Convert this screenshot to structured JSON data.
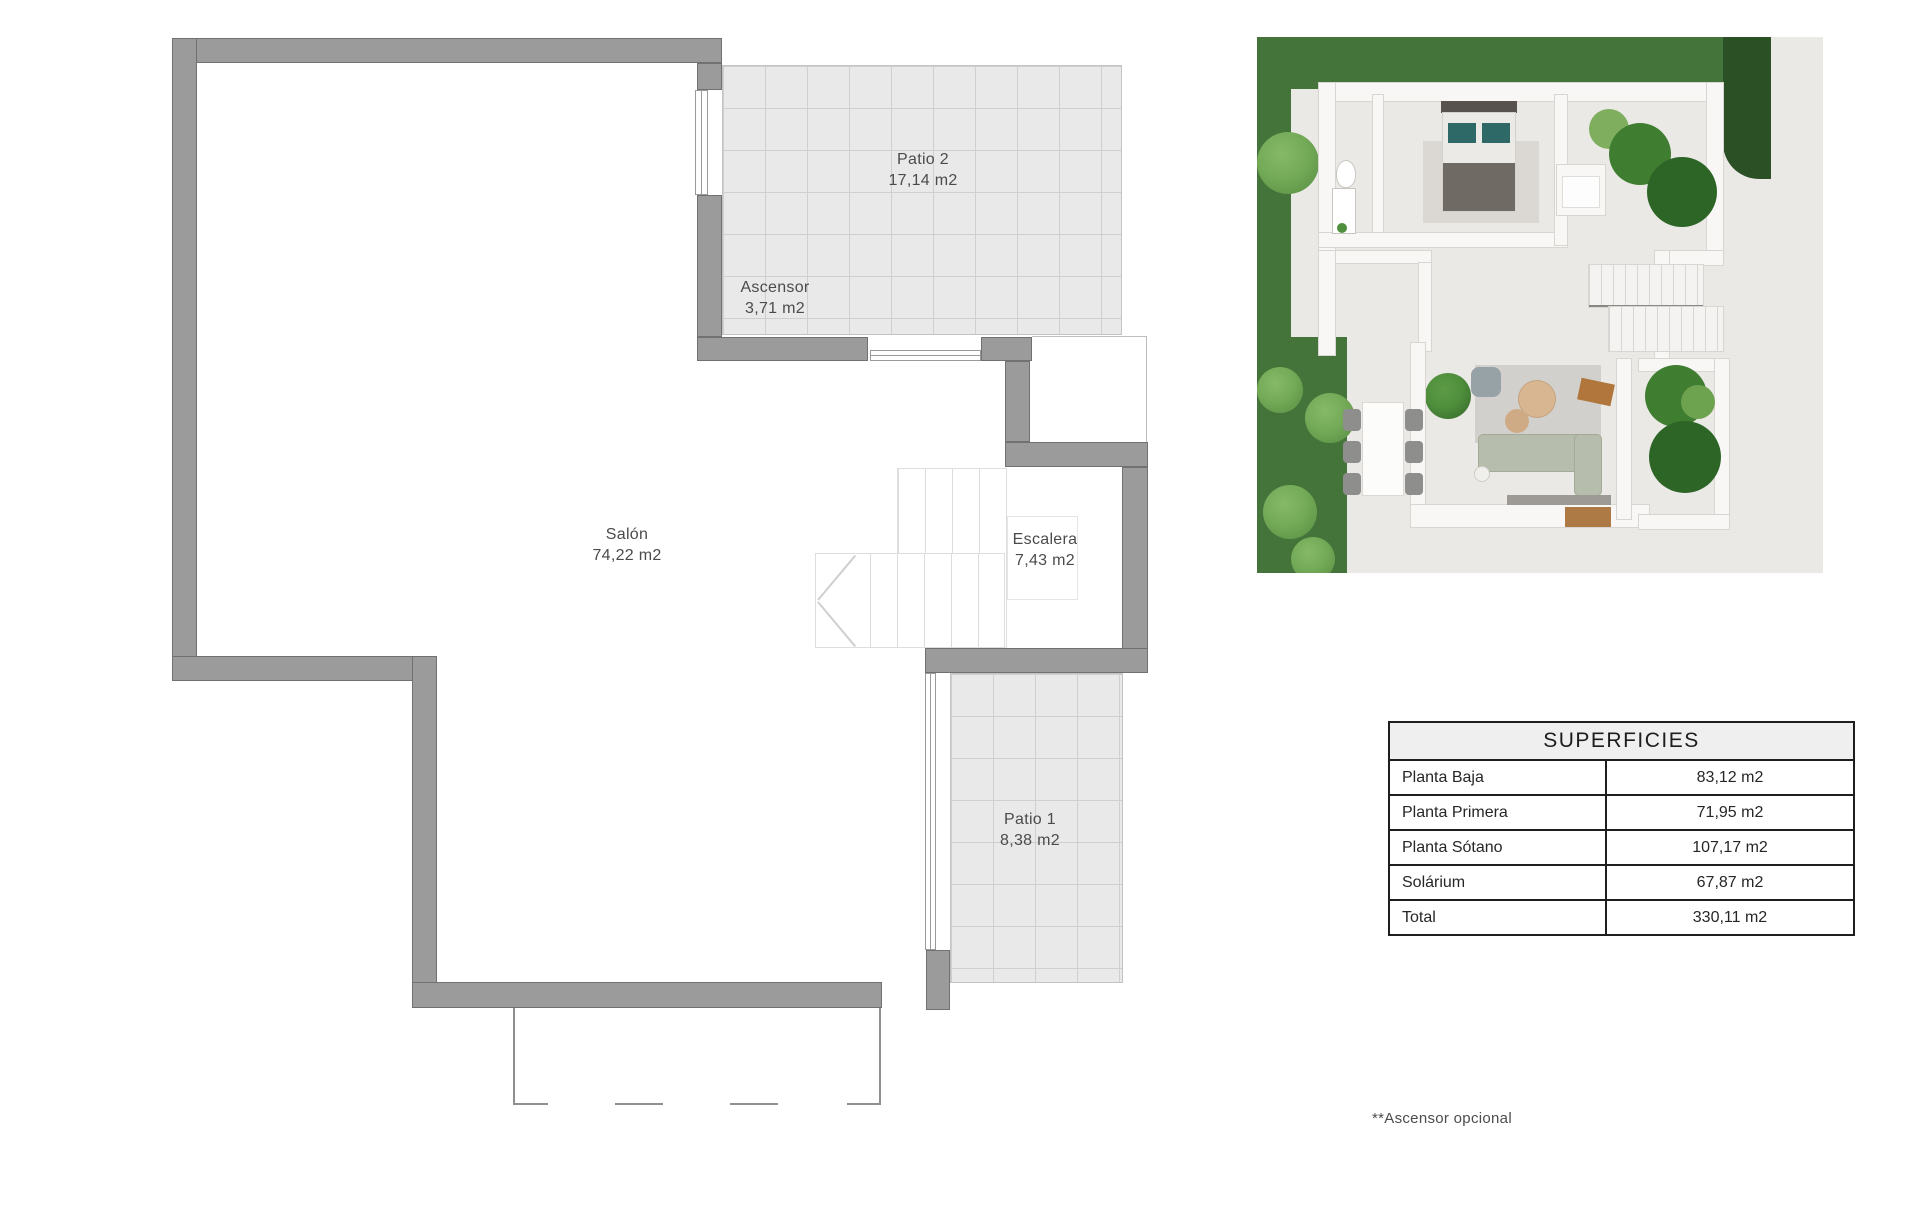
{
  "floorplan": {
    "rooms": [
      {
        "name": "Patio 2",
        "area": "17,14 m2"
      },
      {
        "name": "Ascensor",
        "area": "3,71 m2"
      },
      {
        "name": "Salón",
        "area": "74,22 m2"
      },
      {
        "name": "Escalera",
        "area": "7,43 m2"
      },
      {
        "name": "Patio 1",
        "area": "8,38 m2"
      }
    ]
  },
  "surfaces_table": {
    "title": "SUPERFICIES",
    "rows": [
      {
        "label": "Planta Baja",
        "value": "83,12 m2"
      },
      {
        "label": "Planta Primera",
        "value": "71,95 m2"
      },
      {
        "label": "Planta Sótano",
        "value": "107,17 m2"
      },
      {
        "label": "Solárium",
        "value": "67,87 m2"
      },
      {
        "label": "Total",
        "value": "330,11 m2"
      }
    ]
  },
  "footnote": "**Ascensor opcional",
  "colors": {
    "wall": "#9b9b9b",
    "wall_outline": "#717171",
    "patio_fill": "#e9e9e9",
    "patio_grid_line": "#cfcfcf",
    "grass": "#45743a",
    "hedge": "#2c5026",
    "table_header_bg": "#f0efef",
    "table_border": "#1e1e1e",
    "label_text": "#4b4b4b"
  }
}
